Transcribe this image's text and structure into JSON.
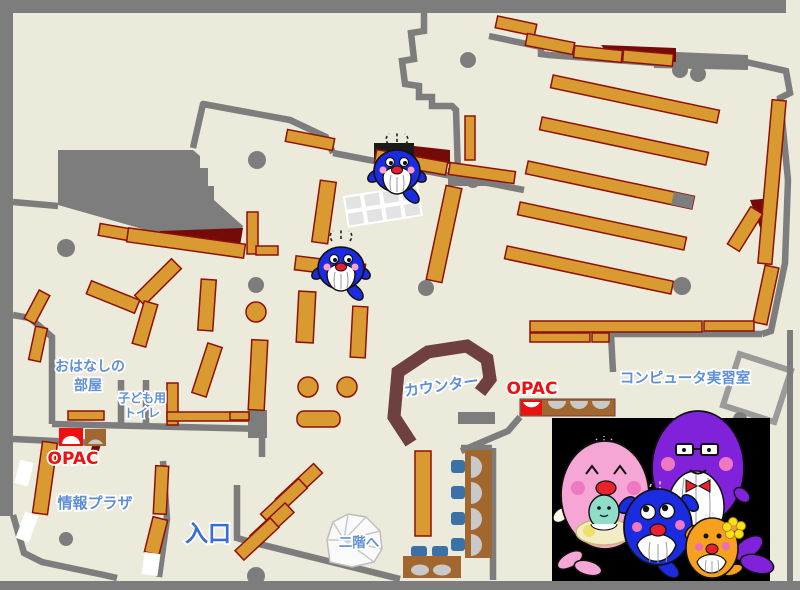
{
  "page": {
    "title": "library-floor-map",
    "width": 800,
    "height": 590
  },
  "labels": {
    "storytelling_room": {
      "line1": "おはなしの",
      "line2": "部屋"
    },
    "kids_toilet": {
      "line1": "子ども用",
      "line2": "トイレ"
    },
    "opac_left": "OPAC",
    "opac_right": "OPAC",
    "counter": "カウンター",
    "computer_room": "コンピュータ実習室",
    "info_plaza": "情報プラザ",
    "entrance": "入口",
    "to_second_floor": "二階へ"
  },
  "colors": {
    "floor": "#ECEADB",
    "wall_gray": "#7D7D7D",
    "shelf_orange": "#D89A31",
    "shelf_border": "#8F1007",
    "dark_red_area": "#740B08",
    "counter_brown": "#6E4040",
    "desk_brown": "#A2672E",
    "chair_blue": "#3A72A8",
    "monitor_gray": "#C9C9C9",
    "label_blue": "#5E8FD6",
    "entrance_blue": "#3A6ED4",
    "opac_red": "#EE1010",
    "photo_background": "#000000",
    "mascot_blue": "#1B2BE0",
    "mascot_pink": "#F5A6D4",
    "mascot_purple": "#7F22D9",
    "mascot_orange": "#F5A01F",
    "mascot_baby_teal": "#8FDCC8"
  },
  "mascots": {
    "map_whales": [
      {
        "name": "blue-whale-mascot",
        "area": "upper-center-shelf"
      },
      {
        "name": "blue-whale-mascot",
        "area": "center-shelf"
      }
    ],
    "family_photo": [
      "pink-mother-whale",
      "purple-father-whale",
      "blue-child-whale",
      "orange-child-whale"
    ]
  }
}
